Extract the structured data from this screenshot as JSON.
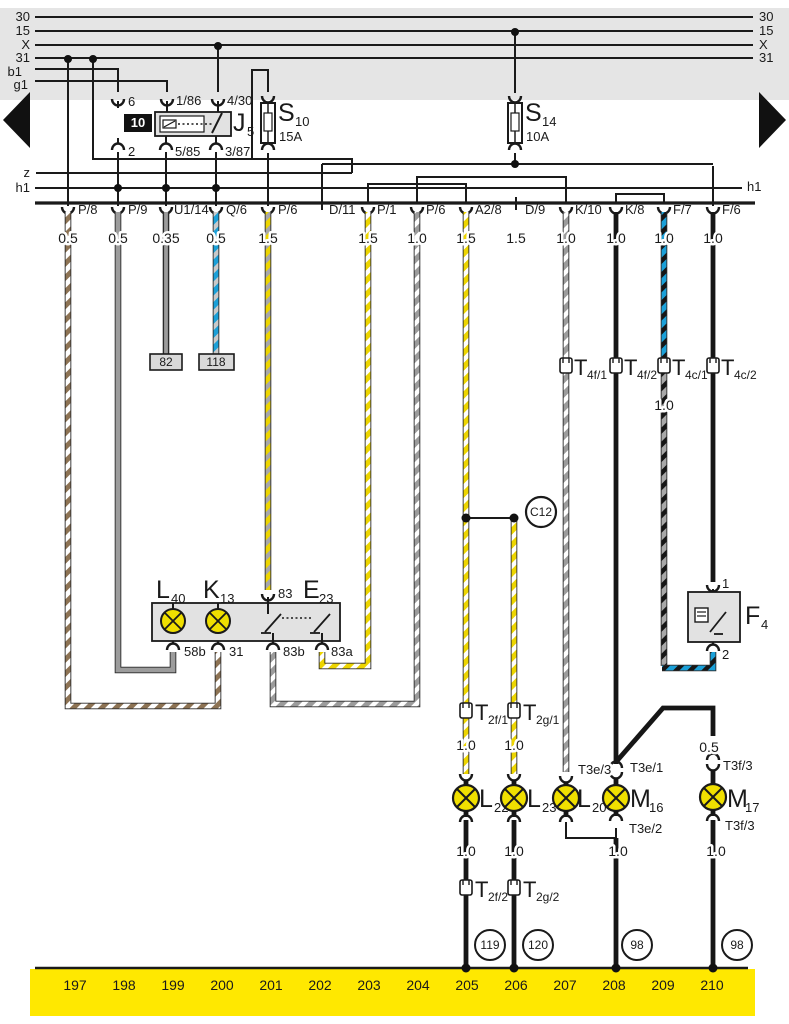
{
  "colors": {
    "bus_band": "#e5e5e5",
    "ground_band": "#ffe800",
    "wire_yellow": "#edd500",
    "wire_brown": "#8d7354",
    "wire_brown_solid": "#a6866a",
    "wire_gray": "#9c9c9c",
    "wire_blue": "#1ba0d8",
    "wire_black": "#161616",
    "lamp_yellow": "#f0df00",
    "component_box": "#e2e2e2"
  },
  "bus": {
    "left_labels": [
      "30",
      "15",
      "X",
      "31"
    ],
    "right_labels": [
      "30",
      "15",
      "X",
      "31"
    ],
    "b1": "b1",
    "g1": "g1",
    "z": "z",
    "h1_left": "h1",
    "h1_right": "h1"
  },
  "relay": {
    "name": "J",
    "sub": "5",
    "slot": "10",
    "pin_top_left": "6",
    "pin_bottom_left": "2",
    "pin_86": "1/86",
    "pin_30": "4/30",
    "pin_85": "5/85",
    "pin_87": "3/87"
  },
  "fuse_s10": {
    "name": "S",
    "sub": "10",
    "rating": "15A"
  },
  "fuse_s14": {
    "name": "S",
    "sub": "14",
    "rating": "10A"
  },
  "row": {
    "c1": {
      "label": "P/8",
      "gauge": "0.5"
    },
    "c2": {
      "label": "P/9",
      "gauge": "0.5"
    },
    "c3": {
      "label": "U1/14",
      "gauge": "0.35"
    },
    "c4": {
      "label": "Q/6",
      "gauge": "0.5"
    },
    "c5": {
      "label": "P/6",
      "gauge": "1.5"
    },
    "c6": {
      "label": "D/11",
      "gauge": ""
    },
    "c7": {
      "label": "P/1",
      "gauge": "1.5"
    },
    "c8": {
      "label": "P/6",
      "gauge": "1.0"
    },
    "c9": {
      "label": "A2/8",
      "gauge": "1.5"
    },
    "c10": {
      "label": "D/9",
      "gauge": "1.5"
    },
    "c11": {
      "label": "K/10",
      "gauge": "1.0"
    },
    "c12": {
      "label": "K/8",
      "gauge": "1.0"
    },
    "c13": {
      "label": "F/7",
      "gauge": "1.0"
    },
    "c14": {
      "label": "F/6",
      "gauge": "1.0"
    }
  },
  "boxes": {
    "b82": "82",
    "b118": "118"
  },
  "t_connectors": {
    "t4f1": {
      "name": "T",
      "sub": "4f/1"
    },
    "t4f2": {
      "name": "T",
      "sub": "4f/2"
    },
    "t4c1": {
      "name": "T",
      "sub": "4c/1"
    },
    "t4c2": {
      "name": "T",
      "sub": "4c/2"
    },
    "t2f1": {
      "name": "T",
      "sub": "2f/1"
    },
    "t2g1": {
      "name": "T",
      "sub": "2g/1"
    },
    "t2f2": {
      "name": "T",
      "sub": "2f/2"
    },
    "t2g2": {
      "name": "T",
      "sub": "2g/2"
    }
  },
  "mid_gauges": {
    "under_t4c1": "1.0",
    "under_t2f1": "1.0",
    "under_t2g1": "1.0",
    "before_t3f3": "0.5",
    "under_l22": "1.0",
    "under_l23": "1.0",
    "under_m16": "1.0",
    "under_m17": "1.0"
  },
  "c12_label": "C12",
  "e23": {
    "name": "E",
    "sub": "23",
    "lamp_l": {
      "name": "L",
      "sub": "40"
    },
    "lamp_r": {
      "name": "K",
      "sub": "13"
    },
    "pin_top": "83",
    "pin1": "58b",
    "pin2": "31",
    "pin3": "83b",
    "pin4": "83a"
  },
  "f4": {
    "name": "F",
    "sub": "4",
    "pin_top": "1",
    "pin_bottom": "2"
  },
  "lamps": {
    "l22": {
      "name": "L",
      "sub": "22"
    },
    "l23": {
      "name": "L",
      "sub": "23"
    },
    "l20": {
      "name": "L",
      "sub": "20"
    },
    "m16": {
      "name": "M",
      "sub": "16"
    },
    "m17": {
      "name": "M",
      "sub": "17"
    }
  },
  "t3": {
    "t3e3": "T3e/3",
    "t3e1": "T3e/1",
    "t3e2": "T3e/2",
    "t3f3_top": "T3f/3",
    "t3f3_bottom": "T3f/3"
  },
  "ground": {
    "numbers": [
      "197",
      "198",
      "199",
      "200",
      "201",
      "202",
      "203",
      "204",
      "205",
      "206",
      "207",
      "208",
      "209",
      "210"
    ],
    "circles": [
      "119",
      "120",
      "98",
      "98"
    ]
  }
}
